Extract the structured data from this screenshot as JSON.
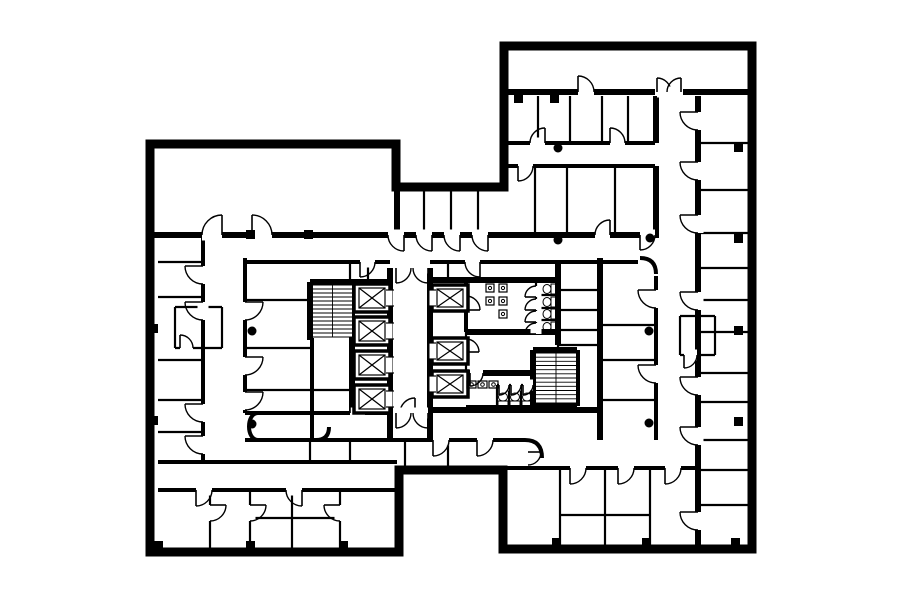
{
  "plan": {
    "canvas": {
      "width": 900,
      "height": 604,
      "background": "#ffffff",
      "ink": "#000000"
    },
    "outline": {
      "stroke_width": 9,
      "points": [
        [
          150,
          144
        ],
        [
          396,
          144
        ],
        [
          396,
          187
        ],
        [
          504,
          187
        ],
        [
          504,
          46
        ],
        [
          752,
          46
        ],
        [
          752,
          549
        ],
        [
          503,
          549
        ],
        [
          503,
          470
        ],
        [
          399,
          470
        ],
        [
          399,
          552
        ],
        [
          150,
          552
        ]
      ]
    },
    "walls": {
      "thick": [
        [
          150,
          235,
          396,
          235
        ],
        [
          396,
          235,
          504,
          235
        ],
        [
          504,
          235,
          650,
          235
        ],
        [
          504,
          92,
          655,
          92
        ],
        [
          683,
          92,
          752,
          92
        ],
        [
          310,
          282,
          392,
          282
        ],
        [
          430,
          280,
          560,
          280
        ],
        [
          430,
          410,
          600,
          410
        ],
        [
          466,
          332,
          558,
          332
        ],
        [
          466,
          373,
          536,
          373
        ],
        [
          466,
          408,
          536,
          408
        ],
        [
          533,
          350,
          577,
          350
        ],
        [
          533,
          406,
          577,
          406
        ],
        [
          352,
          282,
          352,
          413
        ],
        [
          390,
          268,
          390,
          440
        ],
        [
          430,
          268,
          430,
          440
        ],
        [
          310,
          282,
          310,
          340
        ],
        [
          397,
          187,
          397,
          235
        ],
        [
          600,
          258,
          600,
          440
        ],
        [
          656,
          96,
          656,
          143
        ],
        [
          656,
          166,
          656,
          238
        ],
        [
          698,
          96,
          698,
          545
        ],
        [
          533,
          350,
          533,
          406
        ],
        [
          577,
          350,
          577,
          406
        ],
        [
          558,
          262,
          558,
          345
        ]
      ],
      "medium": [
        [
          504,
          143,
          655,
          143
        ],
        [
          504,
          166,
          655,
          166
        ],
        [
          158,
          462,
          397,
          462
        ],
        [
          158,
          490,
          397,
          490
        ],
        [
          503,
          468,
          698,
          468
        ],
        [
          245,
          413,
          392,
          413
        ],
        [
          245,
          440,
          399,
          440
        ],
        [
          399,
          440,
          503,
          440
        ],
        [
          503,
          440,
          525,
          440
        ],
        [
          245,
          262,
          390,
          262
        ],
        [
          430,
          262,
          638,
          262
        ],
        [
          203,
          238,
          203,
          462
        ],
        [
          245,
          258,
          245,
          413
        ],
        [
          312,
          338,
          312,
          440
        ],
        [
          466,
          278,
          466,
          332
        ],
        [
          656,
          276,
          656,
          440
        ]
      ],
      "thin": [
        [
          158,
          262,
          203,
          262
        ],
        [
          158,
          297,
          203,
          297
        ],
        [
          158,
          360,
          203,
          360
        ],
        [
          158,
          400,
          203,
          400
        ],
        [
          158,
          432,
          203,
          432
        ],
        [
          245,
          300,
          312,
          300
        ],
        [
          245,
          348,
          312,
          348
        ],
        [
          245,
          390,
          312,
          390
        ],
        [
          312,
          390,
          352,
          390
        ],
        [
          175,
          307,
          222,
          307
        ],
        [
          175,
          348,
          222,
          348
        ],
        [
          175,
          307,
          175,
          348
        ],
        [
          222,
          307,
          222,
          348
        ],
        [
          536,
          295,
          558,
          295
        ],
        [
          536,
          308,
          558,
          308
        ],
        [
          536,
          320,
          558,
          320
        ],
        [
          536,
          283,
          536,
          333
        ],
        [
          497,
          385,
          533,
          385
        ],
        [
          497,
          385,
          497,
          408
        ],
        [
          509,
          385,
          509,
          408
        ],
        [
          521,
          385,
          521,
          408
        ],
        [
          536,
          373,
          536,
          385
        ],
        [
          558,
          290,
          600,
          290
        ],
        [
          558,
          310,
          600,
          310
        ],
        [
          558,
          330,
          600,
          330
        ],
        [
          558,
          345,
          600,
          345
        ],
        [
          558,
          345,
          558,
          406
        ],
        [
          600,
          325,
          656,
          325
        ],
        [
          600,
          360,
          656,
          360
        ],
        [
          600,
          400,
          656,
          400
        ],
        [
          680,
          316,
          715,
          316
        ],
        [
          680,
          355,
          715,
          355
        ],
        [
          680,
          316,
          680,
          355
        ],
        [
          715,
          316,
          715,
          355
        ],
        [
          698,
          143,
          752,
          143
        ],
        [
          698,
          190,
          752,
          190
        ],
        [
          698,
          233,
          752,
          233
        ],
        [
          698,
          268,
          752,
          268
        ],
        [
          698,
          300,
          752,
          300
        ],
        [
          698,
          332,
          752,
          332
        ],
        [
          698,
          373,
          752,
          373
        ],
        [
          698,
          402,
          752,
          402
        ],
        [
          698,
          440,
          752,
          440
        ],
        [
          698,
          470,
          752,
          470
        ],
        [
          698,
          505,
          752,
          505
        ],
        [
          538,
          96,
          538,
          143
        ],
        [
          570,
          96,
          570,
          143
        ],
        [
          602,
          96,
          602,
          143
        ],
        [
          628,
          96,
          628,
          143
        ],
        [
          535,
          166,
          535,
          235
        ],
        [
          567,
          166,
          567,
          235
        ],
        [
          615,
          166,
          615,
          235
        ],
        [
          424,
          187,
          424,
          233
        ],
        [
          451,
          187,
          451,
          233
        ],
        [
          478,
          187,
          478,
          233
        ],
        [
          405,
          442,
          405,
          470
        ],
        [
          448,
          442,
          448,
          470
        ],
        [
          560,
          468,
          560,
          549
        ],
        [
          605,
          468,
          605,
          549
        ],
        [
          650,
          468,
          650,
          549
        ],
        [
          560,
          515,
          650,
          515
        ],
        [
          210,
          490,
          210,
          552
        ],
        [
          250,
          490,
          250,
          552
        ],
        [
          292,
          490,
          292,
          552
        ],
        [
          340,
          490,
          340,
          552
        ],
        [
          250,
          518,
          340,
          518
        ],
        [
          310,
          440,
          310,
          462
        ],
        [
          350,
          440,
          350,
          462
        ],
        [
          350,
          262,
          350,
          280
        ],
        [
          368,
          262,
          368,
          280
        ],
        [
          448,
          262,
          448,
          280
        ],
        [
          466,
          332,
          466,
          373
        ]
      ]
    },
    "corridor_curves": [
      "M640,258 Q656,258 656,274",
      "M258,413 C246,413 246,440 258,440",
      "M525,440 Q542,440 542,458",
      "M316,440 Q329,440 329,427"
    ],
    "doors": [
      [
        222,
        235,
        20,
        180,
        "h"
      ],
      [
        252,
        235,
        20,
        270,
        "h"
      ],
      [
        404,
        235,
        16,
        90,
        "h"
      ],
      [
        432,
        235,
        16,
        90,
        "h"
      ],
      [
        460,
        235,
        16,
        90,
        "h"
      ],
      [
        488,
        235,
        16,
        90,
        "h"
      ],
      [
        203,
        266,
        18,
        90,
        "v"
      ],
      [
        203,
        302,
        18,
        90,
        "v"
      ],
      [
        203,
        404,
        18,
        90,
        "v"
      ],
      [
        203,
        436,
        18,
        90,
        "v"
      ],
      [
        245,
        302,
        18,
        0,
        "v"
      ],
      [
        245,
        357,
        18,
        0,
        "v"
      ],
      [
        245,
        392,
        18,
        0,
        "v"
      ],
      [
        180,
        348,
        13,
        270,
        "h"
      ],
      [
        415,
        413,
        15,
        180,
        "h"
      ],
      [
        350,
        413,
        15,
        270,
        "h"
      ],
      [
        396,
        413,
        15,
        0,
        "h"
      ],
      [
        428,
        413,
        15,
        90,
        "h"
      ],
      [
        433,
        440,
        16,
        0,
        "h"
      ],
      [
        477,
        440,
        16,
        0,
        "h"
      ],
      [
        396,
        268,
        15,
        0,
        "h"
      ],
      [
        428,
        268,
        15,
        90,
        "h"
      ],
      [
        360,
        262,
        15,
        0,
        "h"
      ],
      [
        480,
        262,
        15,
        90,
        "h"
      ],
      [
        466,
        310,
        14,
        270,
        "v"
      ],
      [
        466,
        352,
        13,
        270,
        "v"
      ],
      [
        470,
        373,
        13,
        0,
        "h"
      ],
      [
        536,
        297,
        11,
        180,
        "v"
      ],
      [
        536,
        310,
        11,
        180,
        "v"
      ],
      [
        536,
        322,
        11,
        180,
        "v"
      ],
      [
        536,
        334,
        11,
        180,
        "v"
      ],
      [
        499,
        385,
        10,
        0,
        "h"
      ],
      [
        511,
        385,
        10,
        0,
        "h"
      ],
      [
        523,
        385,
        10,
        0,
        "h"
      ],
      [
        656,
        290,
        18,
        90,
        "v"
      ],
      [
        656,
        365,
        18,
        90,
        "v"
      ],
      [
        684,
        355,
        13,
        0,
        "h"
      ],
      [
        698,
        112,
        18,
        90,
        "v"
      ],
      [
        698,
        162,
        18,
        90,
        "v"
      ],
      [
        698,
        215,
        18,
        90,
        "v"
      ],
      [
        698,
        292,
        18,
        90,
        "v"
      ],
      [
        698,
        377,
        18,
        90,
        "v"
      ],
      [
        698,
        427,
        18,
        90,
        "v"
      ],
      [
        698,
        512,
        18,
        90,
        "v"
      ],
      [
        578,
        92,
        16,
        270,
        "h"
      ],
      [
        657,
        92,
        14,
        270,
        "h"
      ],
      [
        681,
        92,
        14,
        180,
        "h"
      ],
      [
        545,
        143,
        15,
        180,
        "h"
      ],
      [
        610,
        143,
        15,
        270,
        "h"
      ],
      [
        518,
        166,
        15,
        0,
        "h"
      ],
      [
        610,
        235,
        15,
        180,
        "h"
      ],
      [
        640,
        235,
        15,
        0,
        "h"
      ],
      [
        570,
        468,
        16,
        0,
        "h"
      ],
      [
        618,
        468,
        16,
        0,
        "h"
      ],
      [
        665,
        468,
        16,
        0,
        "h"
      ],
      [
        196,
        490,
        16,
        0,
        "h"
      ],
      [
        302,
        490,
        16,
        90,
        "h"
      ],
      [
        210,
        505,
        16,
        0,
        "v"
      ],
      [
        250,
        505,
        16,
        0,
        "v"
      ],
      [
        340,
        505,
        16,
        90,
        "v"
      ],
      [
        528,
        452,
        13,
        0,
        "v"
      ]
    ],
    "elevators": {
      "west_bank": {
        "door_side": "e",
        "shafts": [
          [
            354,
            284,
            36,
            28
          ],
          [
            354,
            317,
            36,
            28
          ],
          [
            354,
            351,
            36,
            28
          ],
          [
            354,
            385,
            36,
            28
          ]
        ]
      },
      "east_bank": {
        "door_side": "w",
        "shafts": [
          [
            432,
            285,
            36,
            26
          ],
          [
            432,
            338,
            36,
            26
          ],
          [
            432,
            371,
            36,
            26
          ]
        ]
      }
    },
    "stairs": [
      {
        "x": 313,
        "y": 285,
        "w": 39,
        "h": 52,
        "treads": 13
      },
      {
        "x": 536,
        "y": 353,
        "w": 40,
        "h": 50,
        "treads": 12
      }
    ],
    "restrooms": {
      "toilets_facing_west": [
        [
          548,
          289
        ],
        [
          548,
          302
        ],
        [
          548,
          314
        ],
        [
          548,
          327
        ]
      ],
      "toilets_facing_north": [
        [
          503,
          398
        ],
        [
          515,
          398
        ],
        [
          527,
          398
        ]
      ],
      "urinals": [
        [
          486,
          284
        ],
        [
          499,
          284
        ],
        [
          486,
          297
        ],
        [
          499,
          297
        ],
        [
          499,
          310
        ]
      ],
      "sinks": [
        [
          467,
          381
        ],
        [
          478,
          381
        ],
        [
          489,
          381
        ]
      ]
    },
    "columns_round": [
      [
        252,
        331
      ],
      [
        252,
        424
      ],
      [
        558,
        148
      ],
      [
        558,
        240
      ],
      [
        650,
        238
      ],
      [
        649,
        331
      ],
      [
        649,
        423
      ]
    ],
    "columns_square": {
      "size": 9,
      "positions": [
        [
          149,
          324
        ],
        [
          149,
          416
        ],
        [
          154,
          541
        ],
        [
          246,
          541
        ],
        [
          339,
          541
        ],
        [
          246,
          230
        ],
        [
          304,
          230
        ],
        [
          514,
          94
        ],
        [
          550,
          94
        ],
        [
          734,
          143
        ],
        [
          734,
          234
        ],
        [
          734,
          326
        ],
        [
          734,
          417
        ],
        [
          552,
          538
        ],
        [
          642,
          538
        ],
        [
          731,
          538
        ]
      ]
    }
  }
}
